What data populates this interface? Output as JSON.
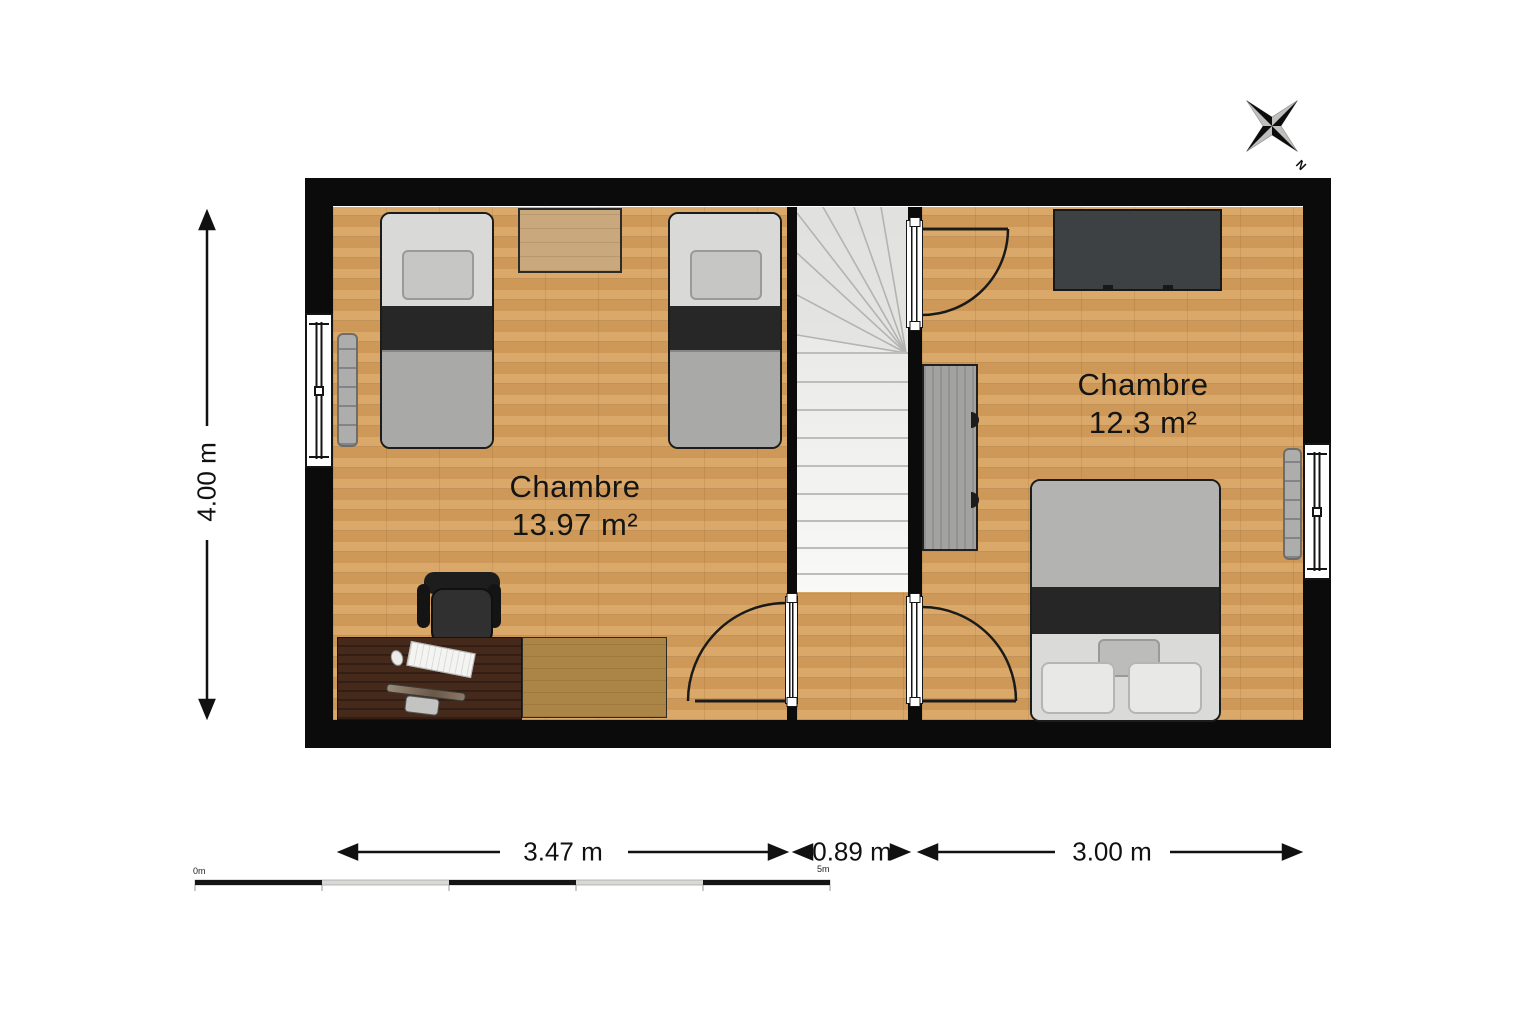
{
  "compass": {
    "north_label": "N"
  },
  "rooms": [
    {
      "name": "Chambre",
      "area": "13.97 m²"
    },
    {
      "name": "Chambre",
      "area": "12.3 m²"
    }
  ],
  "dimensions": {
    "room_left_width": "3.47 m",
    "hall_width": "0.89 m",
    "room_right_width": "3.00 m",
    "plan_height": "4.00 m"
  },
  "scale_bar": {
    "start": "0m",
    "end": "5m"
  },
  "colors": {
    "wall": "#0b0b0b",
    "floor_wood": "#d5a05e",
    "stairs": "#f2f2f0",
    "dark_furniture": "#3e4144",
    "desk_wood": "#45291b",
    "bed_blanket": "#a9a9a7",
    "bed_band": "#272727"
  }
}
